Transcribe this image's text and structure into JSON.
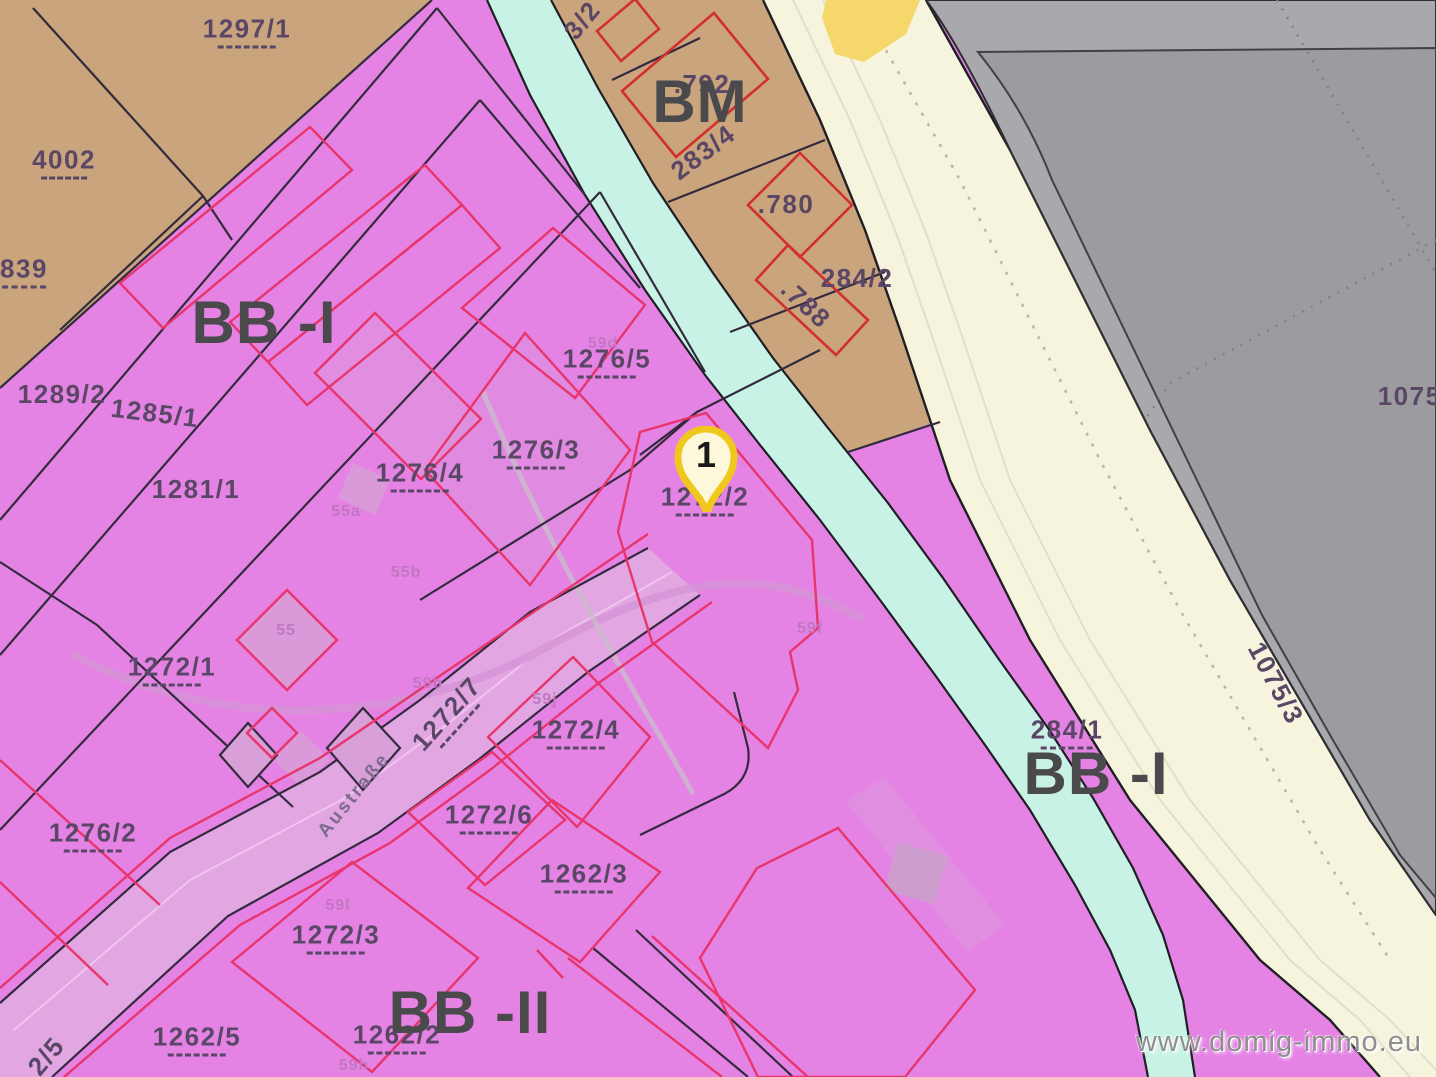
{
  "map": {
    "watermark": "www.domig-immo.eu",
    "marker": {
      "label": "1"
    },
    "zones": [
      {
        "code": "BB -I",
        "meaning": "building-zone-pink"
      },
      {
        "code": "BB -II",
        "meaning": "building-zone-pink"
      },
      {
        "code": "BM",
        "meaning": "mixed-zone-brown"
      }
    ],
    "colors": {
      "pink": "#e583e5",
      "pink-light": "#e2a7e2",
      "building-fill": "#d99fd9",
      "brown": "#c9a47d",
      "stream": "#c9f2e7",
      "road": "#f6f4dc",
      "road-line": "#e0dfca",
      "yellow": "#f6d76b",
      "gray": "#a9a9ad",
      "gray-dark": "#9c9ca0",
      "red": "#d32f2f",
      "rose": "#e8356b",
      "line-dark": "#332b3d",
      "text-parcel": "#5a4766",
      "text-zone": "#4a4a4c",
      "text-minor": "#c176c1",
      "text-street": "#7d6a8d",
      "marker-ring": "#f0c71d",
      "marker-fill": "#fdf8da",
      "watermark-color": "#8f8f8f"
    },
    "labels": [
      {
        "name": "parcel-1297-1",
        "text": "1297/1",
        "x": 247,
        "y": 32,
        "style": "parcel",
        "dashes": true,
        "dw": 58
      },
      {
        "name": "parcel-4002",
        "text": "4002",
        "x": 64,
        "y": 163,
        "style": "parcel",
        "dashes": true,
        "dw": 46
      },
      {
        "name": "parcel-839",
        "text": "839",
        "x": 24,
        "y": 272,
        "style": "parcel",
        "dashes": true,
        "dw": 44
      },
      {
        "name": "zone-bb-1-left",
        "text": "BB -I",
        "x": 264,
        "y": 323,
        "style": "zone"
      },
      {
        "name": "parcel-1289-2",
        "text": "1289/2",
        "x": 62,
        "y": 394,
        "style": "parcel"
      },
      {
        "name": "parcel-1285-1",
        "text": "1285/1",
        "x": 155,
        "y": 413,
        "style": "parcel",
        "rot": 7
      },
      {
        "name": "parcel-1281-1",
        "text": "1281/1",
        "x": 196,
        "y": 489,
        "style": "parcel"
      },
      {
        "name": "minor-55a",
        "text": "55a",
        "x": 346,
        "y": 512,
        "style": "minor"
      },
      {
        "name": "minor-55b",
        "text": "55b",
        "x": 406,
        "y": 573,
        "style": "minor"
      },
      {
        "name": "minor-55",
        "text": "55",
        "x": 286,
        "y": 631,
        "style": "minor"
      },
      {
        "name": "parcel-1276-4",
        "text": "1276/4",
        "x": 420,
        "y": 476,
        "style": "parcel",
        "dashes": true,
        "dw": 58
      },
      {
        "name": "parcel-1276-3",
        "text": "1276/3",
        "x": 536,
        "y": 453,
        "style": "parcel",
        "dashes": true,
        "dw": 58
      },
      {
        "name": "minor-59d",
        "text": "59d",
        "x": 603,
        "y": 344,
        "style": "minor"
      },
      {
        "name": "parcel-1276-5",
        "text": "1276/5",
        "x": 607,
        "y": 362,
        "style": "parcel",
        "dashes": true,
        "dw": 58
      },
      {
        "name": "parcel-1272-2",
        "text": "1272/2",
        "x": 705,
        "y": 500,
        "style": "parcel",
        "dashes": true,
        "dw": 58
      },
      {
        "name": "minor-59f",
        "text": "59f",
        "x": 810,
        "y": 629,
        "style": "minor"
      },
      {
        "name": "parcel-1272-1",
        "text": "1272/1",
        "x": 172,
        "y": 670,
        "style": "parcel",
        "dashes": true,
        "dw": 58
      },
      {
        "name": "parcel-1276-2",
        "text": "1276/2",
        "x": 93,
        "y": 836,
        "style": "parcel",
        "dashes": true,
        "dw": 58
      },
      {
        "name": "street-austrasse",
        "text": "Austraße",
        "x": 354,
        "y": 795,
        "style": "street",
        "rot": -51
      },
      {
        "name": "minor-59b",
        "text": "59b",
        "x": 428,
        "y": 684,
        "style": "minor"
      },
      {
        "name": "parcel-1272-7",
        "text": "1272/7",
        "x": 449,
        "y": 716,
        "style": "parcel",
        "rot": -48,
        "dashes": true,
        "dw": 58
      },
      {
        "name": "minor-59j",
        "text": "59j",
        "x": 545,
        "y": 700,
        "style": "minor"
      },
      {
        "name": "parcel-1272-4",
        "text": "1272/4",
        "x": 576,
        "y": 733,
        "style": "parcel",
        "dashes": true,
        "dw": 58
      },
      {
        "name": "parcel-1272-6",
        "text": "1272/6",
        "x": 489,
        "y": 818,
        "style": "parcel",
        "dashes": true,
        "dw": 58
      },
      {
        "name": "parcel-1262-3",
        "text": "1262/3",
        "x": 584,
        "y": 877,
        "style": "parcel",
        "dashes": true,
        "dw": 58
      },
      {
        "name": "minor-59l",
        "text": "59l",
        "x": 338,
        "y": 906,
        "style": "minor"
      },
      {
        "name": "parcel-1272-3",
        "text": "1272/3",
        "x": 336,
        "y": 938,
        "style": "parcel",
        "dashes": true,
        "dw": 58
      },
      {
        "name": "parcel-1262-5",
        "text": "1262/5",
        "x": 197,
        "y": 1040,
        "style": "parcel",
        "dashes": true,
        "dw": 58
      },
      {
        "name": "parcel-1262-2",
        "text": "1262/2",
        "x": 397,
        "y": 1038,
        "style": "parcel",
        "dashes": true,
        "dw": 58
      },
      {
        "name": "zone-bb-2",
        "text": "BB -II",
        "x": 470,
        "y": 1013,
        "style": "zone"
      },
      {
        "name": "minor-59h",
        "text": "59h",
        "x": 354,
        "y": 1066,
        "style": "minor"
      },
      {
        "name": "parcel-2-5",
        "text": "2/5",
        "x": 46,
        "y": 1056,
        "style": "parcel",
        "rot": -50
      },
      {
        "name": "parcel-283-2",
        "text": "3/2",
        "x": 582,
        "y": 20,
        "style": "parcel",
        "rot": -50
      },
      {
        "name": "parcel-792",
        "text": ".792",
        "x": 702,
        "y": 84,
        "style": "parcel"
      },
      {
        "name": "zone-bm",
        "text": "BM",
        "x": 700,
        "y": 102,
        "style": "zone"
      },
      {
        "name": "parcel-283-4",
        "text": "283/4",
        "x": 703,
        "y": 152,
        "style": "parcel",
        "rot": -37
      },
      {
        "name": "parcel-780",
        "text": ".780",
        "x": 786,
        "y": 204,
        "style": "parcel"
      },
      {
        "name": "parcel-284-2",
        "text": "284/2",
        "x": 857,
        "y": 278,
        "style": "parcel"
      },
      {
        "name": "parcel-788",
        "text": ".788",
        "x": 806,
        "y": 304,
        "style": "parcel",
        "rot": 43
      },
      {
        "name": "parcel-284-1",
        "text": "284/1",
        "x": 1067,
        "y": 733,
        "style": "parcel",
        "dashes": true,
        "dw": 52
      },
      {
        "name": "zone-bb-1-right",
        "text": "BB -I",
        "x": 1096,
        "y": 774,
        "style": "zone"
      },
      {
        "name": "parcel-1075-3",
        "text": "1075/3",
        "x": 1276,
        "y": 683,
        "style": "parcel",
        "rot": 62
      },
      {
        "name": "parcel-1075-edge",
        "text": "1075/",
        "x": 1414,
        "y": 396,
        "style": "parcel"
      }
    ]
  }
}
